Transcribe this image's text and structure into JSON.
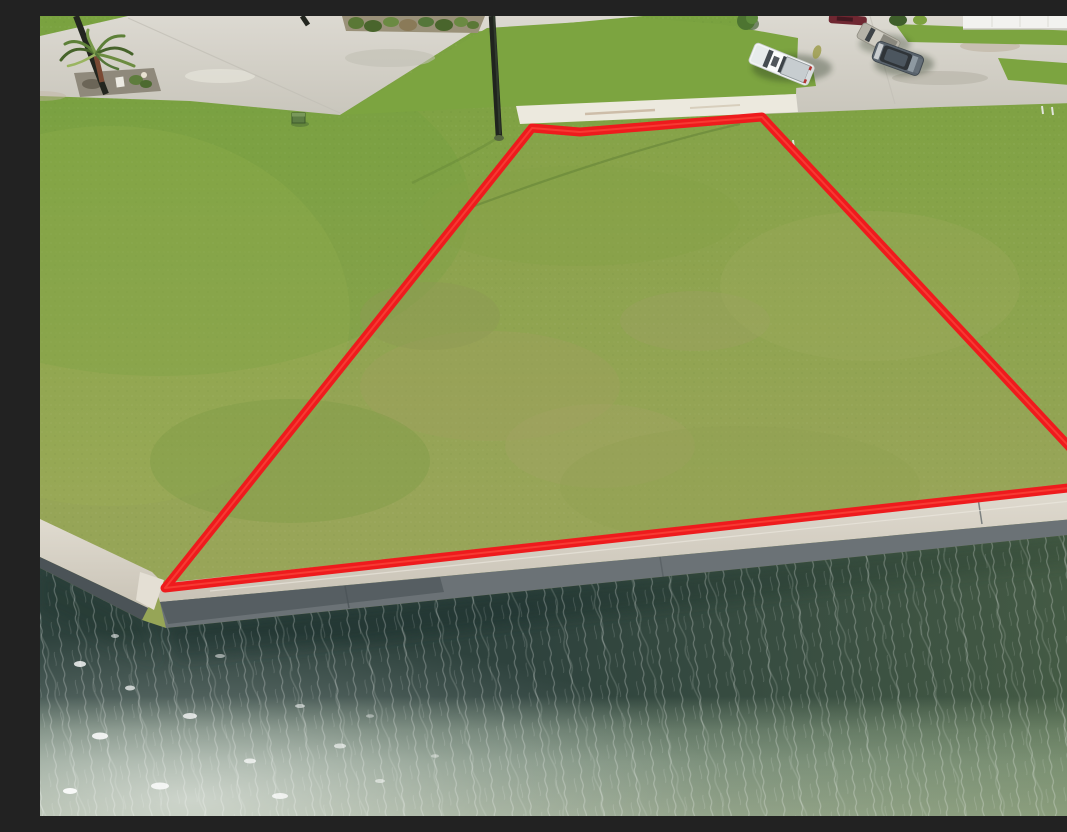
{
  "meta": {
    "title": "Aerial drone photo of a waterfront vacant lot outlined in red",
    "alt": "Bright sunny aerial photograph of a vacant grass waterfront lot. A thick red boundary line traces the trapezoid-shaped parcel. A light concrete street with parked vehicles, a palm tree and a utility pole run along the top; a concrete seawall and green canal water fill the bottom third."
  },
  "scene": {
    "setting": "residential waterfront subdivision on a canal, midday sun",
    "elements": {
      "photo": "aerial drone photograph",
      "grass_field": "mowed green grass lot with dry yellow patches",
      "lot_outline": "red boundary overlay marking the lot lines",
      "street": "light concrete street and cul-de-sac pavement",
      "right_street": "concrete street and driveway slabs with parked vehicles",
      "driveway_apron": "sun-bleached concrete driveway stub at the top of the lot",
      "median_grass": "grass wedge between street sections",
      "palm_tree": "palm tree in a small landscaped bed",
      "palm_bed": "gravel planting bed with shrubs and a white ornament",
      "landscape_island": "landscaped island of shrubs in the pavement",
      "utility_pole": "dark leaning utility pole",
      "center_pole": "dark utility pole at the top edge of the lot",
      "pole_stub": "utility pole at the very top edge of the frame",
      "white_pickup": "white pickup truck with bed cover parked on a driveway",
      "tan_pickup": "tan pickup truck parked beside the street",
      "gray_suv": "dark gray SUV parked on the street",
      "red_car": "dark red vehicle at the top edge of the frame",
      "house": "white house and garage wall at the top right corner",
      "small_tree": "small tree on the grass strip by the street",
      "shrubs": "dark shrubs near the top right houses",
      "utility_box": "small green utility box in the grass",
      "survey_stakes": "small pale survey stakes near the lot",
      "wire_shadow": "thin shadow of an overhead wire crossing the grass",
      "seawall_cap": "light concrete seawall cap along the canal",
      "seawall_face": "gray concrete seawall face above the waterline",
      "canal_water": "green canal water with fine wind ripples",
      "sun_glints": "white sun sparkles on the water at the lower left"
    }
  },
  "lot_outline": {
    "color": "#ee1b1d",
    "stroke_width": 9,
    "points": "492,112 540,116 722,101 1064,468 125,572"
  },
  "palette": {
    "grass_green": "#86a14a",
    "grass_bright": "#7ba33f",
    "grass_dry": "#a3a465",
    "concrete": "#d6d3ca",
    "concrete_bright": "#ece9df",
    "seawall_cap": "#d9d4c8",
    "seawall_face": "#5d6468",
    "water_dark": "#354943",
    "water_mid": "#7d9180",
    "water_light": "#95a58f",
    "outline_red": "#ee1b1d"
  }
}
